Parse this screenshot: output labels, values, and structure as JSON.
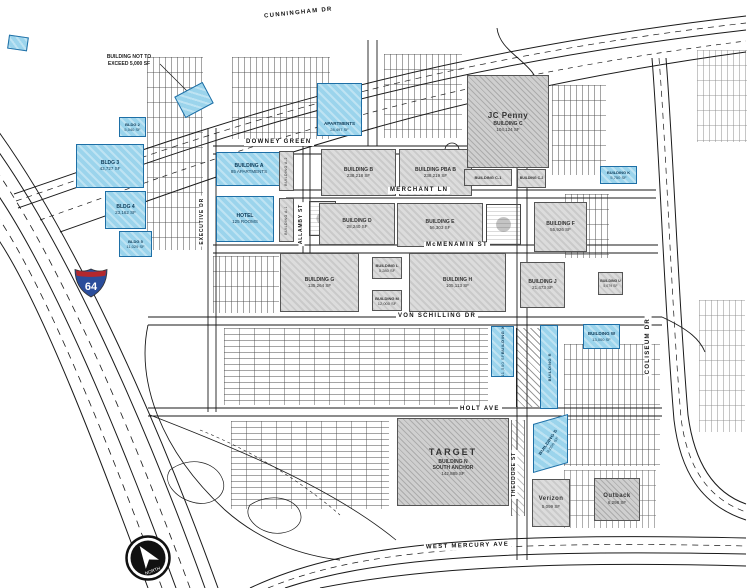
{
  "note": {
    "line1": "BUILDING NOT TO",
    "line2": "EXCEED 5,000 SF"
  },
  "compass": {
    "label": "NORTH"
  },
  "shield": {
    "route": "64"
  },
  "streets": {
    "cunningham": "CUNNINGHAM DR",
    "downey_green": "DOWNEY GREEN",
    "merchant": "MERCHANT LN",
    "mcmenamin": "McMENAMIN ST",
    "von_schilling": "VON SCHILLING DR",
    "holt": "HOLT AVE",
    "west_mercury": "WEST MERCURY AVE",
    "coliseum": "COLISEUM DR",
    "executive": "EXECUTIVE DR",
    "allamby": "ALLAMBY ST",
    "theodore": "THEODORE ST"
  },
  "buildings": {
    "bldg2": {
      "name": "BLDG 2",
      "size": "5,040 SF"
    },
    "bldg3": {
      "name": "BLDG 3",
      "size": "43,727 SF"
    },
    "bldg4": {
      "name": "BLDG 4",
      "size": "23,162 SF"
    },
    "bldg5": {
      "name": "BLDG 5",
      "size": "11,029 SF"
    },
    "apartments": {
      "name": "APARTMENTS",
      "size": "28,497 SF"
    },
    "building_a": {
      "name": "BUILDING A",
      "size": "85 APARTMENTS"
    },
    "hotel": {
      "name": "HOTEL",
      "size": "125 ROOMS"
    },
    "building_a1": {
      "name": "BUILDING A-1"
    },
    "building_a2": {
      "name": "BUILDING A-2"
    },
    "building_b": {
      "name": "BUILDING B",
      "size": "238,218 SF"
    },
    "building_pba_b": {
      "name": "BUILDING PBA B",
      "size": "238,219 SF"
    },
    "jc_penny": {
      "brand": "JC Penny",
      "name": "BUILDING C",
      "size": "104,124 SF"
    },
    "building_c1": {
      "name": "BUILDING C-1"
    },
    "building_c2": {
      "name": "BUILDING C-2"
    },
    "building_k": {
      "name": "BUILDING K",
      "size": "5,750 SF"
    },
    "building_d": {
      "name": "BUILDING D",
      "size": "28,240 SF"
    },
    "building_e": {
      "name": "BUILDING E",
      "size": "56,303 SF"
    },
    "building_f": {
      "name": "BUILDING F",
      "size": "55,926 SF"
    },
    "building_g": {
      "name": "BUILDING G",
      "size": "135,264 SF"
    },
    "building_l": {
      "name": "BUILDING L",
      "size": "5,280 SF"
    },
    "building_m": {
      "name": "BUILDING M",
      "size": "12,000 SF"
    },
    "building_h": {
      "name": "BUILDING H",
      "size": "105,113 SF"
    },
    "building_j": {
      "name": "BUILDING J",
      "size": "21,473 SF"
    },
    "building_u": {
      "name": "BUILDING U",
      "size": "5,079 SF"
    },
    "building_x": {
      "name": "BUILDING X",
      "size": "11,500 SF"
    },
    "building_r": {
      "name": "BUILDING R"
    },
    "building_w": {
      "name": "BUILDING W",
      "size": "13,000 SF"
    },
    "building_s": {
      "name": "BUILDING S",
      "size": "9,000 SF"
    },
    "target": {
      "brand": "TARGET",
      "name": "BUILDING N",
      "role": "SOUTH ANCHOR",
      "size": "142,885 SF"
    },
    "verizon": {
      "brand": "Verizon",
      "size": "5,099 SF"
    },
    "outback": {
      "brand": "Outback",
      "size": "6,298 SF"
    }
  }
}
